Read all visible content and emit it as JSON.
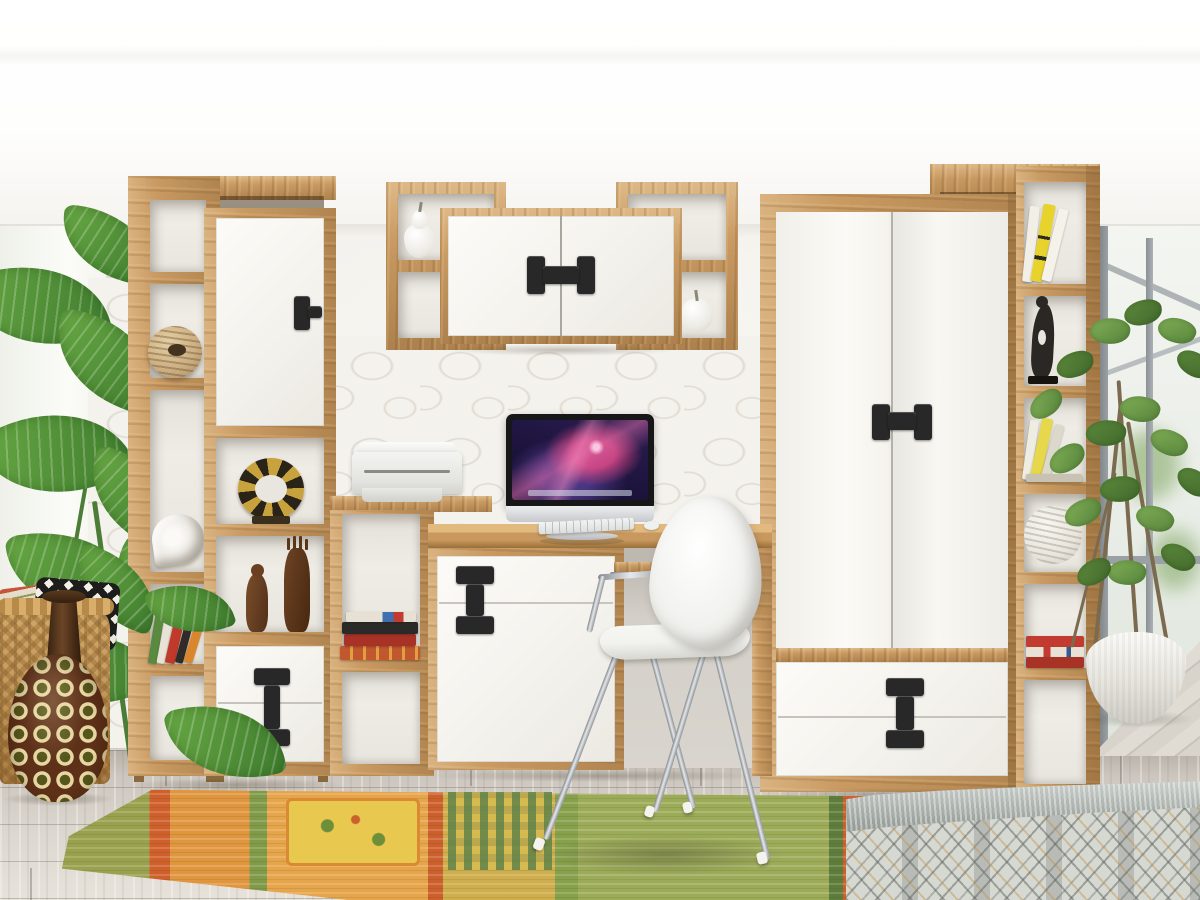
{
  "meta": {
    "description": "Photograph of a teen-room furniture wall: oak shelving tower with white cabinet fronts and black handles, wall-mounted shelf boxes with a white two-door cabinet, an oak desk with an all-in-one computer and printer, a white shell chair on chrome legs, a large two-door wardrobe with lower drawers, a narrow oak bookcase with decor, plants at both windows, a wicker basket with patterned pillows, a tall African vase, an ethnic runner rug on weathered grey plank flooring and the corner of a bed with a grey diamond-pattern blanket.",
    "canvas": {
      "width": 1200,
      "height": 900
    }
  },
  "palette": {
    "oak": "#c99a62",
    "oak-dark": "#a07440",
    "oak-light": "#e0b97f",
    "front-white": "#f5f3ee",
    "handle-black": "#282828",
    "wall": "#f3f1ec",
    "wall-texture": "#ddd8cf",
    "floor-light": "#e2ddd5",
    "floor-dark": "#b5afa6",
    "rug-orange": "#e0953f",
    "rug-green": "#9cab58",
    "rug-red": "#cf5f2b",
    "rug-yellow": "#e3c155",
    "leaf-dark": "#3e7b2e",
    "chrome": "#b9bdc2",
    "chair-white": "#f2f2ef",
    "screen-night": "#1a1238",
    "screen-pink": "#c2407e",
    "blanket-grey": "#d6d8d2",
    "basket-tan": "#c79c5f",
    "vase-brown": "#5d3018"
  },
  "scene": {
    "room": {
      "ceiling": "white",
      "wall": "white wall with 3D pebble accent panels behind the desk and beside the left window",
      "floor": "weathered grey wood planks",
      "windows": [
        "bright left window behind a monstera plant",
        "right window with grey frame and crossed sash bars"
      ]
    },
    "furniture": [
      {
        "id": "left-shelf-tower",
        "label": "oak shelf tower with open niches, white cabinet door and two white drawers",
        "handle": "black bar pulls"
      },
      {
        "id": "wall-shelf-unit",
        "label": "wall-mounted oak boxes flanking a white two-door cabinet",
        "handle": "black H-shaped pull"
      },
      {
        "id": "ladder-shelf",
        "label": "low oak shelf holding books with a printer on top"
      },
      {
        "id": "desk",
        "label": "oak desk with white drawer-and-door pedestal and pull-out keyboard tray",
        "handle": "black I-shaped pull"
      },
      {
        "id": "chair",
        "label": "white moulded shell chair with chrome legs and white floor caps"
      },
      {
        "id": "wardrobe",
        "label": "oak-framed wardrobe with two white doors and two lower drawers",
        "handles": [
          "black H-shaped pull",
          "black I-shaped pull"
        ]
      },
      {
        "id": "right-bookcase",
        "label": "narrow oak bookcase with top bridge shelf"
      }
    ],
    "electronics": [
      {
        "id": "imac",
        "label": "silver all-in-one computer showing a purple-pink galaxy wallpaper with dock"
      },
      {
        "id": "keyboard",
        "label": "white keyboard and mouse"
      },
      {
        "id": "printer",
        "label": "white inkjet printer"
      }
    ],
    "decor": [
      {
        "id": "woven-ball",
        "label": "woven rattan ball vase"
      },
      {
        "id": "shell",
        "label": "white spiral shell ornament"
      },
      {
        "id": "gold-ring",
        "label": "gold and black ring ornament"
      },
      {
        "id": "wood-figurines",
        "label": "two carved wooden figurines"
      },
      {
        "id": "ceramic-pear",
        "label": "white ceramic pear"
      },
      {
        "id": "ceramic-apple",
        "label": "white ceramic apple"
      },
      {
        "id": "black-figurine",
        "label": "black abstract sculpture"
      },
      {
        "id": "yarn-ball",
        "label": "white yarn ball"
      },
      {
        "id": "books",
        "label": "assorted colourful books on several shelves"
      }
    ],
    "soft_items": [
      {
        "id": "rug",
        "label": "orange-green ethnic runner rug with medallions and checked bands"
      },
      {
        "id": "bed",
        "label": "bed corner with grey diamond-pattern blanket and grey knit throw"
      },
      {
        "id": "pillow-red",
        "label": "red striped ethnic pillow"
      },
      {
        "id": "pillow-chevron",
        "label": "black and white chevron pillow"
      },
      {
        "id": "basket",
        "label": "wicker basket"
      },
      {
        "id": "vase",
        "label": "tall dark vase with cream geometric squares"
      }
    ],
    "plants": [
      {
        "id": "monstera",
        "label": "monstera plant at the left window"
      },
      {
        "id": "ficus",
        "label": "ficus tree in a round white ribbed planter"
      }
    ]
  }
}
